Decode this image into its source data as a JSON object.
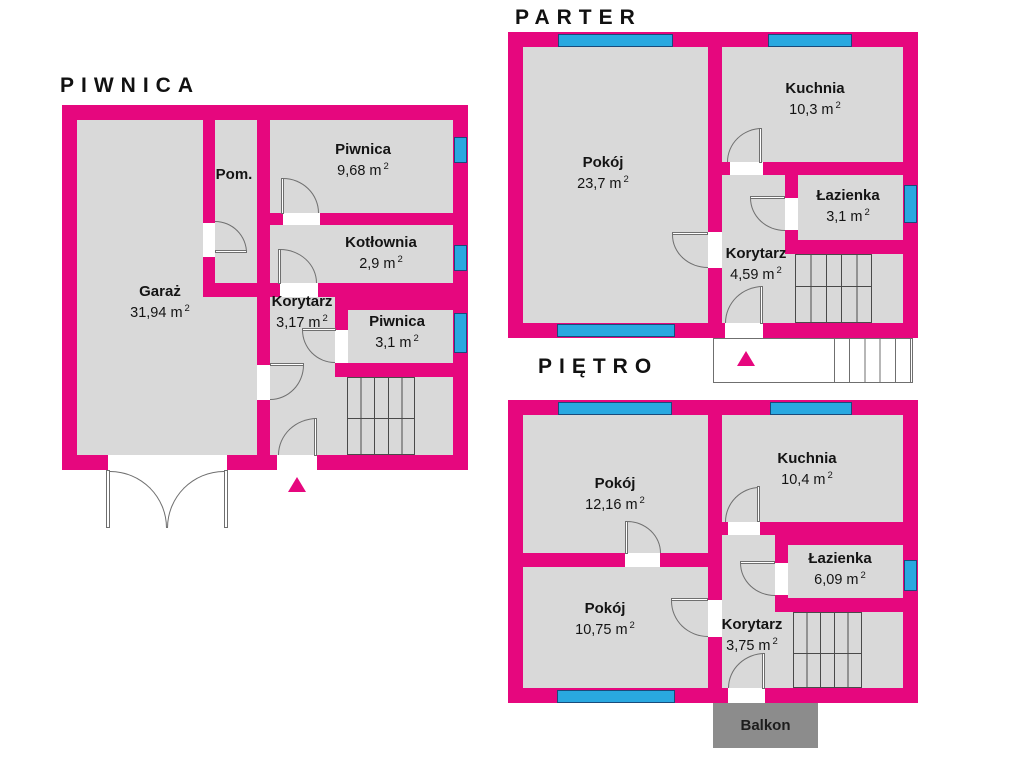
{
  "colors": {
    "wall": "#E6077E",
    "floor_fill": "#D9D9D9",
    "window": "#29A8E0",
    "balcony_fill": "#8C8C8C"
  },
  "floors": {
    "piwnica": {
      "title": "PIWNICA",
      "rooms": {
        "garaz": {
          "name": "Garaż",
          "area": "31,94 m",
          "area_sup": "2"
        },
        "pom": {
          "name": "Pom."
        },
        "piwnica_968": {
          "name": "Piwnica",
          "area": "9,68 m",
          "area_sup": "2"
        },
        "kotlownia": {
          "name": "Kotłownia",
          "area": "2,9 m",
          "area_sup": "2"
        },
        "korytarz": {
          "name": "Korytarz",
          "area": "3,17 m",
          "area_sup": "2"
        },
        "piwnica_31": {
          "name": "Piwnica",
          "area": "3,1 m",
          "area_sup": "2"
        }
      }
    },
    "parter": {
      "title": "PARTER",
      "rooms": {
        "pokoj": {
          "name": "Pokój",
          "area": "23,7 m",
          "area_sup": "2"
        },
        "kuchnia": {
          "name": "Kuchnia",
          "area": "10,3 m",
          "area_sup": "2"
        },
        "lazienka": {
          "name": "Łazienka",
          "area": "3,1 m",
          "area_sup": "2"
        },
        "korytarz": {
          "name": "Korytarz",
          "area": "4,59 m",
          "area_sup": "2"
        }
      }
    },
    "pietro": {
      "title": "PIĘTRO",
      "rooms": {
        "pokoj_1216": {
          "name": "Pokój",
          "area": "12,16 m",
          "area_sup": "2"
        },
        "kuchnia": {
          "name": "Kuchnia",
          "area": "10,4 m",
          "area_sup": "2"
        },
        "lazienka": {
          "name": "Łazienka",
          "area": "6,09 m",
          "area_sup": "2"
        },
        "pokoj_1075": {
          "name": "Pokój",
          "area": "10,75 m",
          "area_sup": "2"
        },
        "korytarz": {
          "name": "Korytarz",
          "area": "3,75 m",
          "area_sup": "2"
        }
      }
    }
  },
  "balcony": {
    "label": "Balkon"
  }
}
